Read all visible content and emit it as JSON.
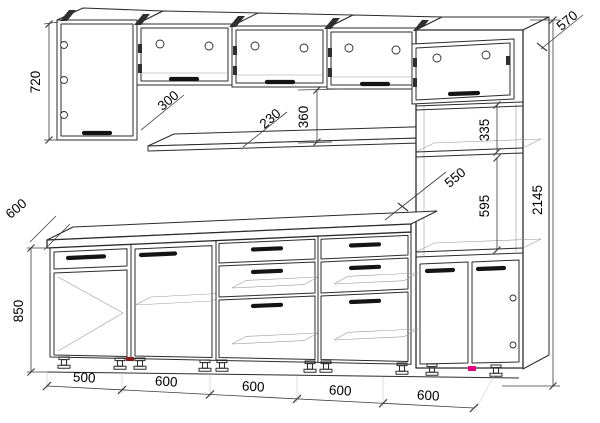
{
  "drawing": {
    "type": "kitchen-cabinet-assembly-drawing",
    "colors": {
      "line": "#2b2b2b",
      "dimension": "#3c3c3c",
      "accent_dark_red": "#8b1a1a",
      "accent_pink": "#e5007d"
    },
    "dims": {
      "wall_cabinet_height": "720",
      "wall_cabinet_depth": "300",
      "wall_shelf_depth": "230",
      "upper_section_height": "360",
      "tall_unit_depth": "570",
      "tall_unit_upper_section": "335",
      "tall_unit_inner_depth": "550",
      "tall_unit_niche_height": "595",
      "total_height": "2145",
      "worktop_depth": "600",
      "base_unit_height": "850",
      "base_unit_widths": [
        "500",
        "600",
        "600",
        "600",
        "600"
      ]
    }
  }
}
